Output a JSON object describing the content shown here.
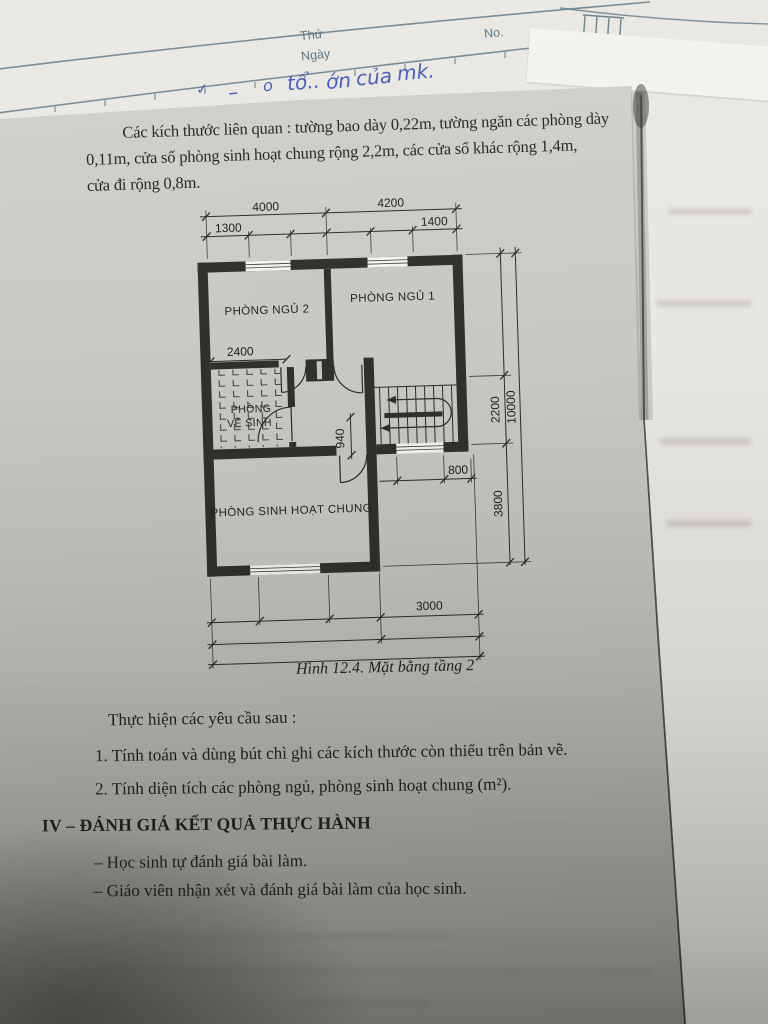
{
  "photo": {
    "notebook": {
      "weekday_label": "Thứ",
      "date_label": "Ngày",
      "number_label": "No.",
      "handwriting_words": [
        "✓",
        "–",
        "o",
        "tổ..",
        "ớn",
        "của",
        "mk."
      ],
      "ink_blue": "#2d48c0",
      "ruled_line_color": "#5d7684"
    },
    "worksheet": {
      "intro_lines": [
        "Các kích thước liên quan : tường bao dày 0,22m, tường ngăn các phòng dày",
        "0,11m, cửa sổ phòng sinh hoạt chung rộng 2,2m, các cửa sổ khác rộng 1,4m,",
        "cửa đi rộng 0,8m."
      ],
      "figure": {
        "caption": "Hình 12.4. Mặt bằng tầng 2",
        "room_labels": {
          "bedroom2": "PHÒNG NGỦ 2",
          "bedroom1": "PHÒNG NGỦ 1",
          "bathroom_line1": "PHÒNG",
          "bathroom_line2": "VỆ SINH",
          "living": "PHÒNG SINH HOẠT CHUNG"
        },
        "dimensions": {
          "top_span_left": "4000",
          "top_span_right": "4200",
          "top_sub_left": "1300",
          "top_sub_right": "1400",
          "bedroom2_inner": "2400",
          "hall_width": "940",
          "stair_landing": "800",
          "right_mid": "2200",
          "right_lower": "3800",
          "right_total": "10000",
          "bottom_span": "3000"
        },
        "wall_color": "#31302d"
      },
      "tasks": {
        "intro": "Thực hiện các yêu cầu sau :",
        "item1": "1. Tính toán và dùng bút chì ghi các kích thước còn thiếu trên bản vẽ.",
        "item2": "2. Tính diện tích các phòng ngủ, phòng sinh hoạt chung (m²)."
      },
      "evaluation": {
        "heading": "IV – ĐÁNH GIÁ KẾT QUẢ THỰC HÀNH",
        "item1": "– Học sinh tự đánh giá bài làm.",
        "item2": "– Giáo viên nhận xét và đánh giá bài làm của học sinh."
      },
      "print_color": "#26241f"
    }
  }
}
